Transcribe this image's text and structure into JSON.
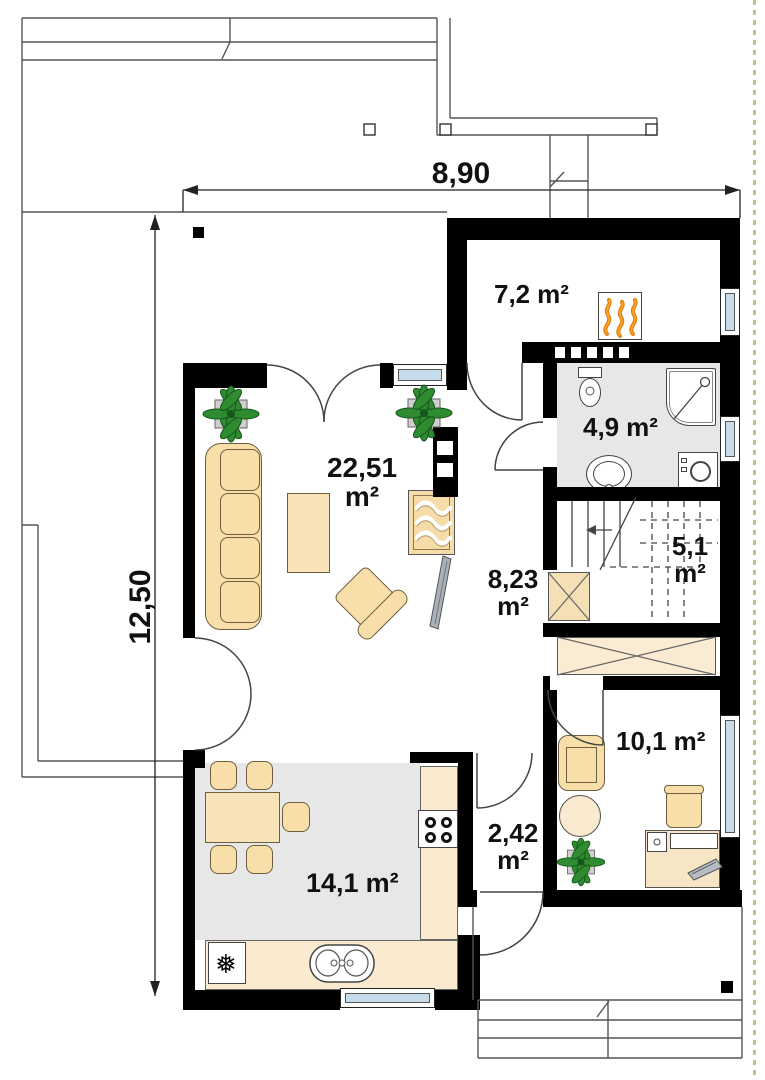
{
  "dimensions": {
    "width": "8,90",
    "height": "12,50"
  },
  "rooms": [
    {
      "name": "utility-room",
      "area": "7,2",
      "unit": "m²"
    },
    {
      "name": "bathroom",
      "area": "4,9",
      "unit": "m²"
    },
    {
      "name": "living-room",
      "area": "22,51",
      "unit": "m²"
    },
    {
      "name": "staircase",
      "area": "5,1",
      "unit": "m²"
    },
    {
      "name": "hall",
      "area": "8,23",
      "unit": "m²"
    },
    {
      "name": "office",
      "area": "10,1",
      "unit": "m²"
    },
    {
      "name": "vestibule",
      "area": "2,42",
      "unit": "m²"
    },
    {
      "name": "kitchen-dining",
      "area": "14,1",
      "unit": "m²"
    }
  ],
  "icons": {
    "freezer": "❅"
  },
  "colors": {
    "wall": "#000000",
    "floor_gray": "#e7e7e7",
    "furniture_tan": "#f8dfa9",
    "cabinet_beige": "#faecd2",
    "window_glass": "#c7dcea",
    "flame_orange": "#e8860b",
    "plant_green": "#2f8b2f"
  }
}
